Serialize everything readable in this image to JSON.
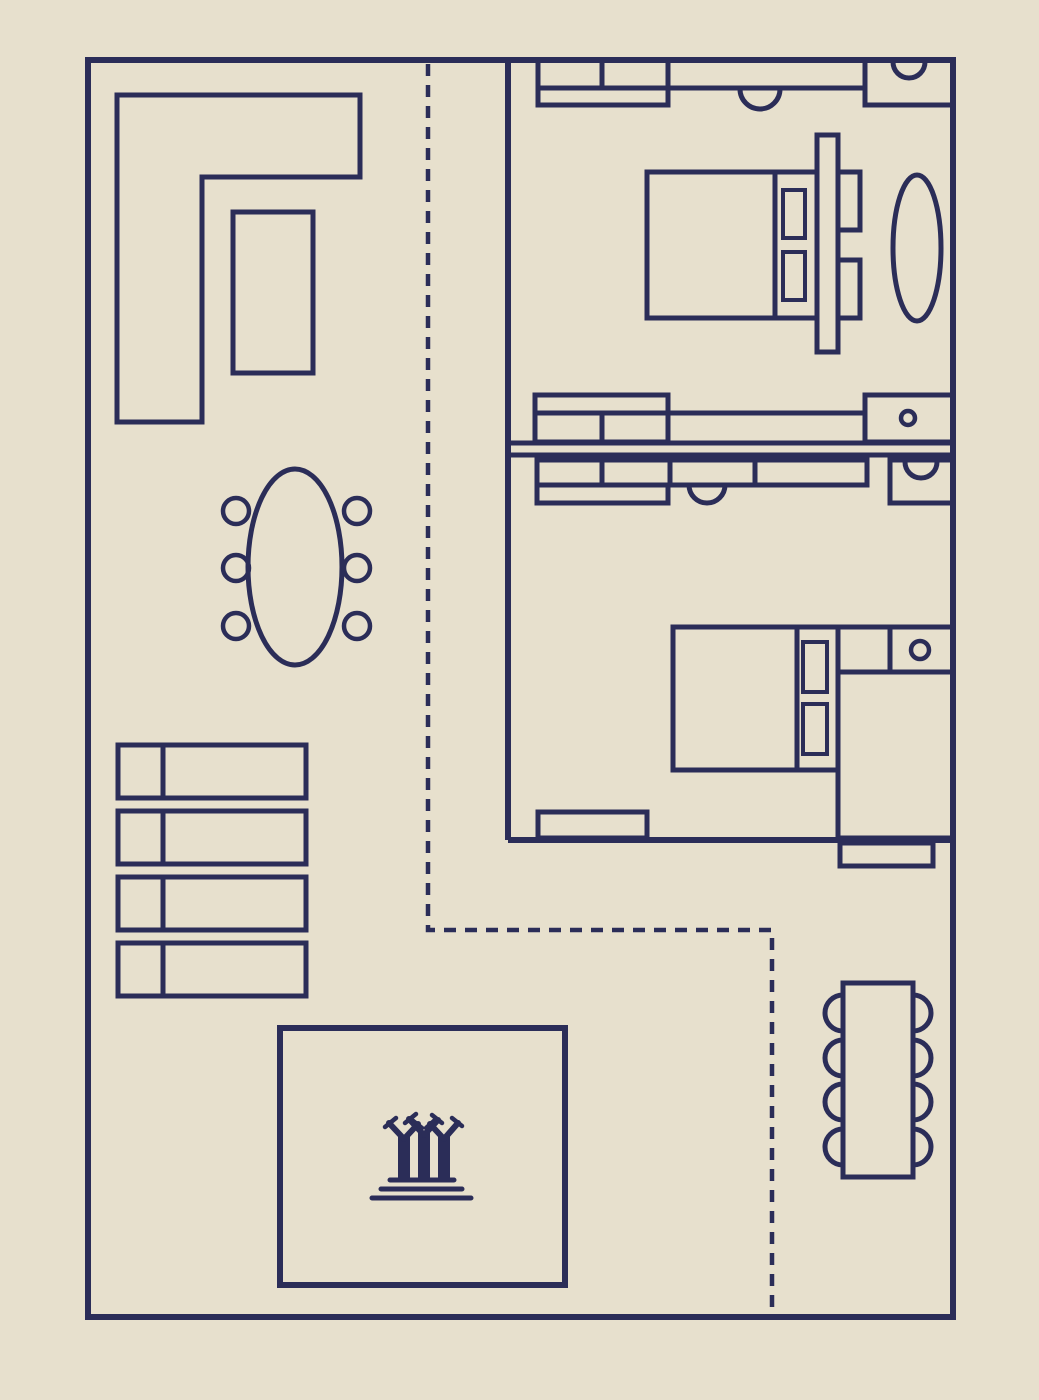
{
  "canvas": {
    "width": 1039,
    "height": 1400,
    "background_color": "#e7e0cd",
    "line_color": "#2b2d58",
    "dash_pattern": "12 9"
  },
  "plan": {
    "circulation": [
      {
        "name": "walkway-dashed-path",
        "kind": "polyline",
        "points": "428,64 428,930 772,930 772,1314",
        "stroke": 4.5,
        "dashed": true
      }
    ],
    "living_area": [
      {
        "name": "sectional-sofa",
        "kind": "path",
        "d": "M117,95 L360,95 L360,177 L202,177 L202,422 L117,422 Z",
        "stroke": 5
      },
      {
        "name": "coffee-table",
        "kind": "rect",
        "x": 233,
        "y": 212,
        "w": 80,
        "h": 161,
        "stroke": 5
      }
    ],
    "dining_area": [
      {
        "name": "dining-table",
        "kind": "ellipse",
        "cx": 295,
        "cy": 567,
        "rx": 47,
        "ry": 98,
        "stroke": 5
      },
      {
        "name": "dining-chair",
        "kind": "circle",
        "cx": 236,
        "cy": 511,
        "r": 13,
        "stroke": 4.5
      },
      {
        "name": "dining-chair",
        "kind": "circle",
        "cx": 236,
        "cy": 568,
        "r": 13,
        "stroke": 4.5
      },
      {
        "name": "dining-chair",
        "kind": "circle",
        "cx": 236,
        "cy": 626,
        "r": 13,
        "stroke": 4.5
      },
      {
        "name": "dining-chair",
        "kind": "circle",
        "cx": 357,
        "cy": 511,
        "r": 13,
        "stroke": 4.5
      },
      {
        "name": "dining-chair",
        "kind": "circle",
        "cx": 357,
        "cy": 568,
        "r": 13,
        "stroke": 4.5
      },
      {
        "name": "dining-chair",
        "kind": "circle",
        "cx": 357,
        "cy": 626,
        "r": 13,
        "stroke": 4.5
      }
    ],
    "storage_shelves": [
      {
        "name": "shelf-unit",
        "kind": "rect",
        "x": 118,
        "y": 745,
        "w": 188,
        "h": 53,
        "stroke": 5
      },
      {
        "name": "shelf-divider",
        "kind": "line",
        "x1": 163,
        "y1": 745,
        "x2": 163,
        "y2": 798,
        "stroke": 5
      },
      {
        "name": "shelf-unit",
        "kind": "rect",
        "x": 118,
        "y": 811,
        "w": 188,
        "h": 53,
        "stroke": 5
      },
      {
        "name": "shelf-divider",
        "kind": "line",
        "x1": 163,
        "y1": 811,
        "x2": 163,
        "y2": 864,
        "stroke": 5
      },
      {
        "name": "shelf-unit",
        "kind": "rect",
        "x": 118,
        "y": 877,
        "w": 188,
        "h": 53,
        "stroke": 5
      },
      {
        "name": "shelf-divider",
        "kind": "line",
        "x1": 163,
        "y1": 877,
        "x2": 163,
        "y2": 930,
        "stroke": 5
      },
      {
        "name": "shelf-unit",
        "kind": "rect",
        "x": 118,
        "y": 943,
        "w": 188,
        "h": 53,
        "stroke": 5
      },
      {
        "name": "shelf-divider",
        "kind": "line",
        "x1": 163,
        "y1": 943,
        "x2": 163,
        "y2": 996,
        "stroke": 5
      }
    ],
    "courtyard": [
      {
        "name": "courtyard-room",
        "kind": "rect",
        "x": 280,
        "y": 1028,
        "w": 285,
        "h": 257,
        "stroke": 6
      },
      {
        "name": "supertrees-icon-trunks",
        "kind": "path",
        "d": "M404,1181 L404,1135 M424,1181 L424,1131 M444,1181 L444,1135",
        "stroke": 12
      },
      {
        "name": "supertrees-icon-branches",
        "kind": "path",
        "d": "M404,1139 L389,1123 M404,1139 L418,1124 M424,1135 L409,1119 M424,1135 L438,1120 M444,1139 L430,1124 M444,1139 L458,1123",
        "stroke": 6,
        "cap": "round"
      },
      {
        "name": "supertrees-icon-tips",
        "kind": "path",
        "d": "M385,1127 L396,1118 M412,1120 L422,1128 M405,1123 L416,1114 M432,1115 L442,1123 M426,1128 L436,1119 M452,1118 L462,1126",
        "stroke": 4.5,
        "cap": "round"
      },
      {
        "name": "supertrees-icon-base",
        "kind": "path",
        "d": "M390,1180 L454,1180 M381,1189 L462,1189 M372,1198 L471,1198",
        "stroke": 5,
        "cap": "round"
      }
    ],
    "bedroom_upper": [
      {
        "name": "wardrobe-top",
        "kind": "rect",
        "x": 538,
        "y": 60,
        "w": 130,
        "h": 45,
        "stroke": 5
      },
      {
        "name": "wardrobe-top-divider",
        "kind": "line",
        "x1": 602,
        "y1": 60,
        "x2": 602,
        "y2": 88,
        "stroke": 5
      },
      {
        "name": "counter-line",
        "kind": "line",
        "x1": 538,
        "y1": 88,
        "x2": 865,
        "y2": 88,
        "stroke": 5
      },
      {
        "name": "counter-door-arc",
        "kind": "path",
        "d": "M740,89 A20,20 0 0 0 780,89",
        "stroke": 5
      },
      {
        "name": "vanity-cabinet",
        "kind": "rect",
        "x": 865,
        "y": 60,
        "w": 88,
        "h": 45,
        "stroke": 5
      },
      {
        "name": "vanity-sink-arc",
        "kind": "path",
        "d": "M893,62 A16,16 0 0 0 925,62",
        "stroke": 5
      },
      {
        "name": "bed-frame",
        "kind": "rect",
        "x": 647,
        "y": 172,
        "w": 170,
        "h": 146,
        "stroke": 5
      },
      {
        "name": "bed-divider",
        "kind": "line",
        "x1": 775,
        "y1": 172,
        "x2": 775,
        "y2": 318,
        "stroke": 5
      },
      {
        "name": "pillow",
        "kind": "rect",
        "x": 783,
        "y": 190,
        "w": 22,
        "h": 48,
        "stroke": 4
      },
      {
        "name": "pillow",
        "kind": "rect",
        "x": 783,
        "y": 252,
        "w": 22,
        "h": 48,
        "stroke": 4
      },
      {
        "name": "headboard",
        "kind": "rect",
        "x": 817,
        "y": 135,
        "w": 21,
        "h": 217,
        "stroke": 5
      },
      {
        "name": "nightstand",
        "kind": "rect",
        "x": 838,
        "y": 172,
        "w": 22,
        "h": 58,
        "stroke": 5
      },
      {
        "name": "nightstand",
        "kind": "rect",
        "x": 838,
        "y": 260,
        "w": 22,
        "h": 58,
        "stroke": 5
      },
      {
        "name": "bedside-rug",
        "kind": "ellipse",
        "cx": 917,
        "cy": 248,
        "rx": 24,
        "ry": 73,
        "stroke": 5
      },
      {
        "name": "dresser",
        "kind": "rect",
        "x": 535,
        "y": 395,
        "w": 133,
        "h": 47,
        "stroke": 5
      },
      {
        "name": "dresser-counter-line",
        "kind": "line",
        "x1": 535,
        "y1": 413,
        "x2": 865,
        "y2": 413,
        "stroke": 5
      },
      {
        "name": "dresser-divider",
        "kind": "line",
        "x1": 602,
        "y1": 413,
        "x2": 602,
        "y2": 442,
        "stroke": 5
      },
      {
        "name": "cabinet-knob-box",
        "kind": "rect",
        "x": 865,
        "y": 395,
        "w": 88,
        "h": 47,
        "stroke": 5
      },
      {
        "name": "cabinet-knob",
        "kind": "circle",
        "cx": 908,
        "cy": 418,
        "r": 7,
        "stroke": 4.5
      }
    ],
    "bedroom_lower": [
      {
        "name": "cabinet-run",
        "kind": "rect",
        "x": 537,
        "y": 460,
        "w": 330,
        "h": 25,
        "stroke": 5
      },
      {
        "name": "cabinet-run-divider",
        "kind": "line",
        "x1": 602,
        "y1": 460,
        "x2": 602,
        "y2": 485,
        "stroke": 5
      },
      {
        "name": "cabinet-run-divider",
        "kind": "line",
        "x1": 670,
        "y1": 460,
        "x2": 670,
        "y2": 485,
        "stroke": 5
      },
      {
        "name": "cabinet-run-divider",
        "kind": "line",
        "x1": 755,
        "y1": 460,
        "x2": 755,
        "y2": 485,
        "stroke": 5
      },
      {
        "name": "cabinet-door-arc",
        "kind": "path",
        "d": "M689,485 A18,18 0 0 0 725,485",
        "stroke": 5
      },
      {
        "name": "cabinet-shelf",
        "kind": "rect",
        "x": 537,
        "y": 485,
        "w": 131,
        "h": 18,
        "stroke": 5
      },
      {
        "name": "vanity-cabinet",
        "kind": "rect",
        "x": 890,
        "y": 460,
        "w": 63,
        "h": 43,
        "stroke": 5
      },
      {
        "name": "vanity-sink-arc",
        "kind": "path",
        "d": "M905,462 A16,16 0 0 0 937,462",
        "stroke": 5
      },
      {
        "name": "bed-frame",
        "kind": "rect",
        "x": 673,
        "y": 627,
        "w": 165,
        "h": 143,
        "stroke": 5
      },
      {
        "name": "bed-divider",
        "kind": "line",
        "x1": 797,
        "y1": 627,
        "x2": 797,
        "y2": 770,
        "stroke": 5
      },
      {
        "name": "pillow",
        "kind": "rect",
        "x": 803,
        "y": 642,
        "w": 24,
        "h": 50,
        "stroke": 4
      },
      {
        "name": "pillow",
        "kind": "rect",
        "x": 803,
        "y": 704,
        "w": 24,
        "h": 50,
        "stroke": 4
      },
      {
        "name": "nightstand-unit",
        "kind": "rect",
        "x": 838,
        "y": 627,
        "w": 115,
        "h": 45,
        "stroke": 5
      },
      {
        "name": "nightstand-divider",
        "kind": "line",
        "x1": 890,
        "y1": 627,
        "x2": 890,
        "y2": 672,
        "stroke": 5
      },
      {
        "name": "cabinet-knob",
        "kind": "circle",
        "cx": 920,
        "cy": 650,
        "r": 9,
        "stroke": 4.5
      },
      {
        "name": "wardrobe",
        "kind": "rect",
        "x": 838,
        "y": 672,
        "w": 115,
        "h": 166,
        "stroke": 5
      },
      {
        "name": "door-threshold",
        "kind": "rect",
        "x": 538,
        "y": 812,
        "w": 109,
        "h": 26,
        "stroke": 5
      },
      {
        "name": "hall-cabinet",
        "kind": "rect",
        "x": 840,
        "y": 843,
        "w": 93,
        "h": 23,
        "stroke": 5
      }
    ],
    "terrace": [
      {
        "name": "outdoor-table",
        "kind": "rect",
        "x": 843,
        "y": 983,
        "w": 70,
        "h": 194,
        "stroke": 5
      },
      {
        "name": "terrace-chair",
        "kind": "path",
        "d": "M843,995 A18,18 0 0 0 843,1031",
        "stroke": 5
      },
      {
        "name": "terrace-chair",
        "kind": "path",
        "d": "M843,1040 A18,18 0 0 0 843,1076",
        "stroke": 5
      },
      {
        "name": "terrace-chair",
        "kind": "path",
        "d": "M843,1084 A18,18 0 0 0 843,1120",
        "stroke": 5
      },
      {
        "name": "terrace-chair",
        "kind": "path",
        "d": "M843,1129 A18,18 0 0 0 843,1165",
        "stroke": 5
      },
      {
        "name": "terrace-chair",
        "kind": "path",
        "d": "M913,995 A18,18 0 0 1 913,1031",
        "stroke": 5
      },
      {
        "name": "terrace-chair",
        "kind": "path",
        "d": "M913,1040 A18,18 0 0 1 913,1076",
        "stroke": 5
      },
      {
        "name": "terrace-chair",
        "kind": "path",
        "d": "M913,1084 A18,18 0 0 1 913,1120",
        "stroke": 5
      },
      {
        "name": "terrace-chair",
        "kind": "path",
        "d": "M913,1129 A18,18 0 0 1 913,1165",
        "stroke": 5
      }
    ],
    "walls": [
      {
        "name": "outer-wall",
        "kind": "rect",
        "x": 88,
        "y": 60,
        "w": 865,
        "h": 1257,
        "stroke": 6
      },
      {
        "name": "bedroom-partition-wall",
        "kind": "line",
        "x1": 508,
        "y1": 60,
        "x2": 508,
        "y2": 840,
        "stroke": 6
      },
      {
        "name": "bedroom-lower-wall",
        "kind": "line",
        "x1": 508,
        "y1": 840,
        "x2": 953,
        "y2": 840,
        "stroke": 6
      },
      {
        "name": "bedroom-divider-wall-line",
        "kind": "line",
        "x1": 508,
        "y1": 443,
        "x2": 953,
        "y2": 443,
        "stroke": 5
      },
      {
        "name": "bedroom-divider-wall-line",
        "kind": "line",
        "x1": 508,
        "y1": 455,
        "x2": 953,
        "y2": 455,
        "stroke": 5
      }
    ]
  }
}
